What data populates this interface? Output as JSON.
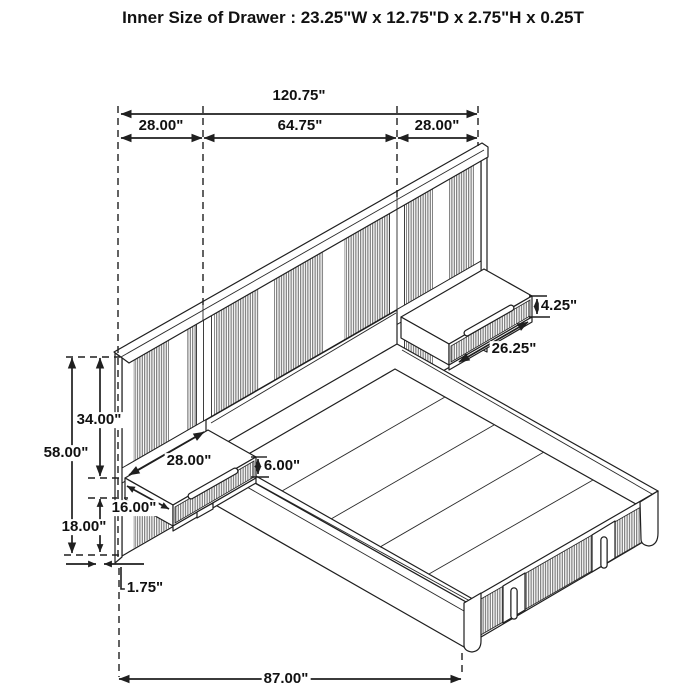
{
  "title": "Inner Size of Drawer : 23.25\"W x 12.75\"D x 2.75\"H x 0.25T",
  "dimensions": {
    "total_width": "120.75\"",
    "left_section": "28.00\"",
    "center_section": "64.75\"",
    "right_section": "28.00\"",
    "right_shelf_front_height": "4.25\"",
    "right_shelf_width": "26.25\"",
    "upper_panel_height": "34.00\"",
    "total_height": "58.00\"",
    "left_shelf_width": "28.00\"",
    "left_shelf_front_height": "6.00\"",
    "left_shelf_depth": "16.00\"",
    "lower_panel_height": "18.00\"",
    "panel_thickness": "1.75\"",
    "bed_length": "87.00\""
  },
  "colors": {
    "line": "#1f1f1f",
    "stripe": "#606060",
    "background": "#ffffff"
  }
}
